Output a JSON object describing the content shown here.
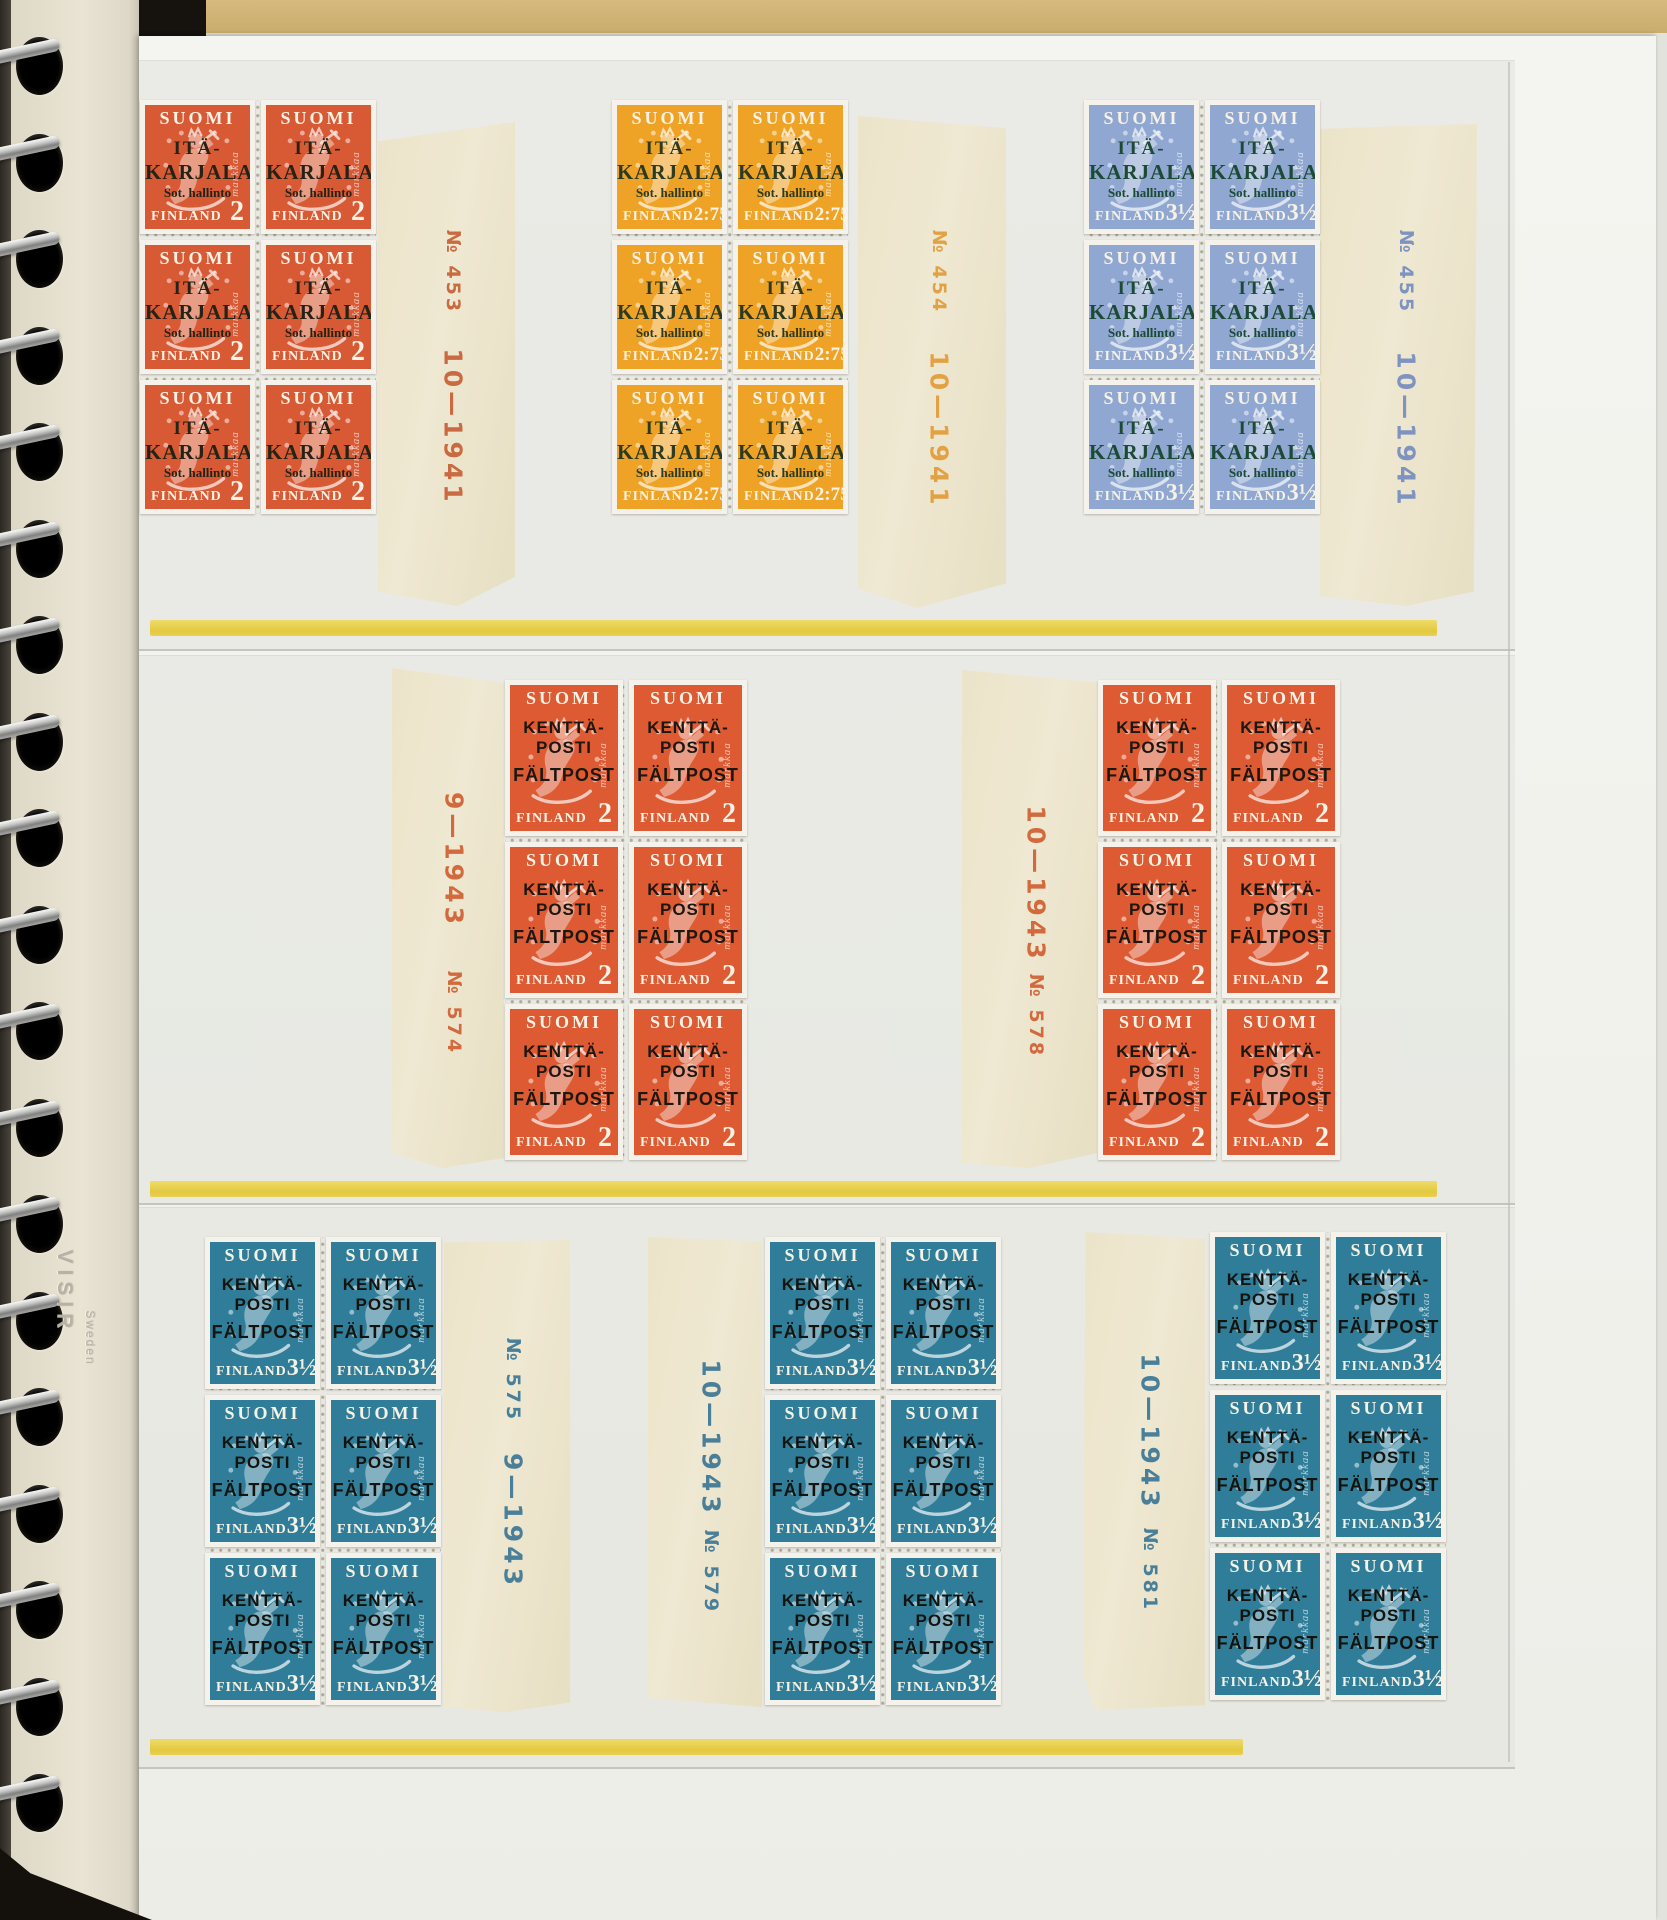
{
  "album": {
    "embossing_brand": "VISIR",
    "embossing_origin": "Sweden",
    "binding_holes": 19
  },
  "palette": {
    "page_white": "#f2f2ed",
    "cover_black": "#16130e",
    "desk_tan": "#d0b476",
    "yellow_rule": "#e5cc45",
    "tab_paper": "#ebe3c9",
    "binding_paper": "#e8e3d2"
  },
  "stamp_text": {
    "country": "SUOMI",
    "bottom_word": "FINLAND",
    "side_word": "markkaa"
  },
  "rows": [
    {
      "id": "ita-karjala-1941",
      "blocks": [
        {
          "plate": "№ 453",
          "date": "10—1941",
          "denomination": "2",
          "overprint": [
            "ITÄ-",
            "KARJALA",
            "Sot. hallinto"
          ],
          "overprint_font": "serif",
          "tab_side": "right",
          "tab_order": [
            "plate",
            "date"
          ],
          "colors": {
            "face": "#d85a35",
            "overprint": "#262216",
            "tab_ink": "#ca6a40"
          }
        },
        {
          "plate": "№ 454",
          "date": "10—1941",
          "denomination": "2:75",
          "overprint": [
            "ITÄ-",
            "KARJALA",
            "Sot. hallinto"
          ],
          "overprint_font": "serif",
          "tab_side": "right",
          "tab_order": [
            "plate",
            "date"
          ],
          "colors": {
            "face": "#efa326",
            "overprint": "#2c3a22",
            "tab_ink": "#e2a243"
          }
        },
        {
          "plate": "№ 455",
          "date": "10—1941",
          "denomination": "3½",
          "overprint": [
            "ITÄ-",
            "KARJALA",
            "Sot. hallinto"
          ],
          "overprint_font": "serif",
          "tab_side": "right",
          "tab_order": [
            "plate",
            "date"
          ],
          "colors": {
            "face": "#8fa7d1",
            "overprint": "#1d4a35",
            "tab_ink": "#7e93c0"
          }
        }
      ]
    },
    {
      "id": "kenttaposti-2mk-1943",
      "blocks": [
        {
          "plate": "№ 574",
          "date": "9—1943",
          "denomination": "2",
          "overprint": [
            "KENTTÄ-",
            "POSTI",
            "FÄLTPOST"
          ],
          "overprint_font": "sans",
          "tab_side": "left",
          "tab_order": [
            "date",
            "plate"
          ],
          "colors": {
            "face": "#dd5a33",
            "overprint": "#1b1811",
            "tab_ink": "#d26a3e"
          }
        },
        {
          "plate": "№ 578",
          "date": "10—1943",
          "denomination": "2",
          "overprint": [
            "KENTTÄ-",
            "POSTI",
            "FÄLTPOST"
          ],
          "overprint_font": "sans",
          "tab_side": "left",
          "tab_order": [
            "date",
            "plate"
          ],
          "colors": {
            "face": "#dd5a33",
            "overprint": "#1b1811",
            "tab_ink": "#d26a3e"
          }
        }
      ]
    },
    {
      "id": "kenttaposti-3half-mk-1943",
      "blocks": [
        {
          "plate": "№ 575",
          "date": "9—1943",
          "denomination": "3½",
          "overprint": [
            "KENTTÄ-",
            "POSTI",
            "FÄLTPOST"
          ],
          "overprint_font": "sans",
          "tab_side": "right",
          "tab_order": [
            "plate",
            "date"
          ],
          "colors": {
            "face": "#2f7d99",
            "overprint": "#15130e",
            "tab_ink": "#4a7f99"
          }
        },
        {
          "plate": "№ 579",
          "date": "10—1943",
          "denomination": "3½",
          "overprint": [
            "KENTTÄ-",
            "POSTI",
            "FÄLTPOST"
          ],
          "overprint_font": "sans",
          "tab_side": "left",
          "tab_order": [
            "date",
            "plate"
          ],
          "colors": {
            "face": "#2f7d99",
            "overprint": "#15130e",
            "tab_ink": "#4a7f99"
          }
        },
        {
          "plate": "№ 581",
          "date": "10—1943",
          "denomination": "3½",
          "overprint": [
            "KENTTÄ-",
            "POSTI",
            "FÄLTPOST"
          ],
          "overprint_font": "sans",
          "tab_side": "left",
          "tab_order": [
            "date",
            "plate"
          ],
          "colors": {
            "face": "#2f7d99",
            "overprint": "#15130e",
            "tab_ink": "#4a7f99"
          }
        }
      ]
    }
  ]
}
